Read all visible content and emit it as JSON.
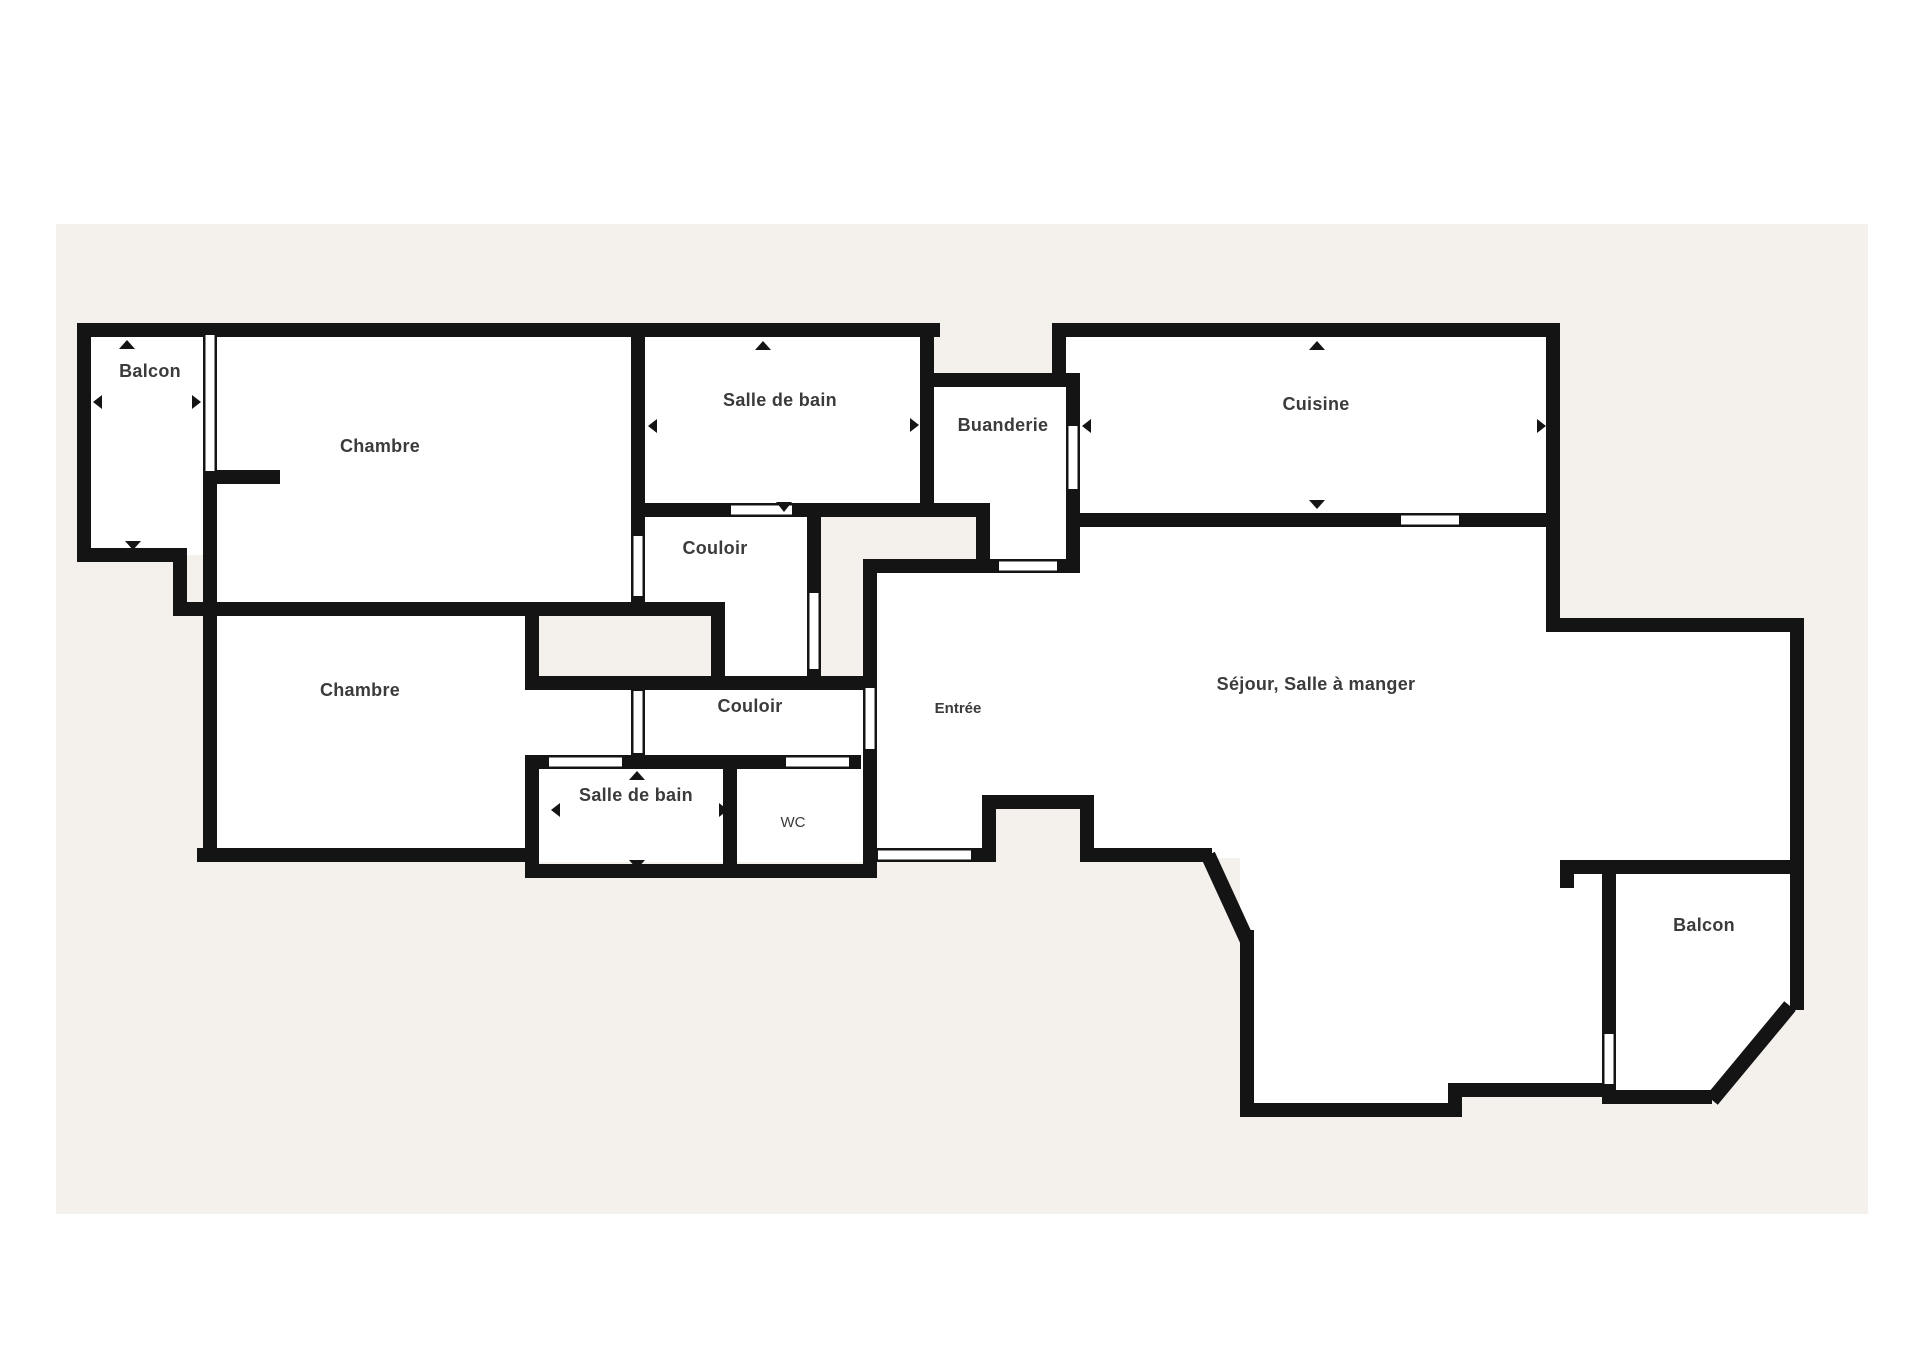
{
  "plan": {
    "type": "apartment-floor-plan",
    "colors": {
      "page_background": "#ffffff",
      "panel_background": "#f4f0ec",
      "wall": "#141414",
      "floor": "#ffffff",
      "label_text": "#3b3b3b"
    },
    "rooms": {
      "balcon_tl": {
        "label": "Balcon"
      },
      "chambre_top": {
        "label": "Chambre"
      },
      "salle_de_bain_top": {
        "label": "Salle de bain"
      },
      "buanderie": {
        "label": "Buanderie"
      },
      "cuisine": {
        "label": "Cuisine"
      },
      "couloir_top": {
        "label": "Couloir"
      },
      "chambre_bottom": {
        "label": "Chambre"
      },
      "couloir_bottom": {
        "label": "Couloir"
      },
      "entree": {
        "label": "Entrée"
      },
      "sejour": {
        "label": "Séjour, Salle à manger"
      },
      "salle_de_bain_bottom": {
        "label": "Salle de bain"
      },
      "wc": {
        "label": "WC"
      },
      "balcon_br": {
        "label": "Balcon"
      }
    }
  }
}
